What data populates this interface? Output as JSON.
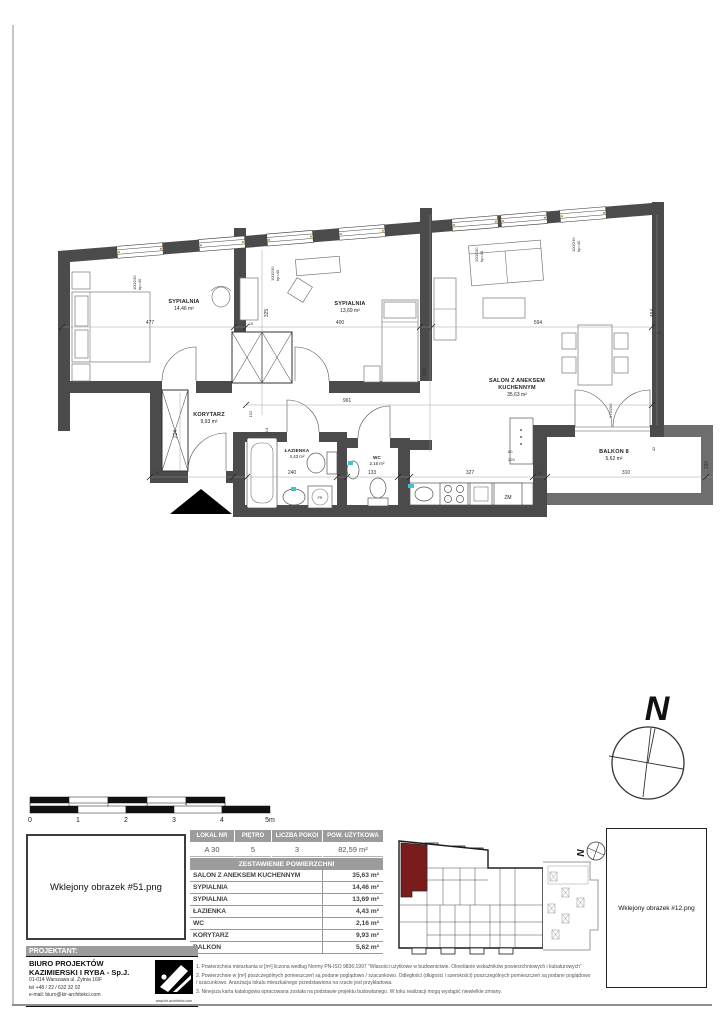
{
  "page": {
    "left_placeholder": "Wklejony obrazek #51.png",
    "right_placeholder": "Wklejony obrazek #12.png"
  },
  "plan": {
    "rooms": {
      "s1": {
        "name": "SYPIALNIA",
        "area": "14,46 m²"
      },
      "s2": {
        "name": "SYPIALNIA",
        "area": "13,69 m²"
      },
      "salon": {
        "l1": "SALON Z ANEKSEM",
        "l2": "KUCHENNYM",
        "area": "35,63 m²"
      },
      "korytarz": {
        "name": "KORYTARZ",
        "area": "9,93 m²"
      },
      "lazienka": {
        "name": "ŁAZIENKA",
        "area": "4,43 m²"
      },
      "wc": {
        "name": "WC",
        "area": "2,16 m²"
      },
      "balkon": {
        "name": "BALKON 8",
        "area": "5,62 m²"
      }
    },
    "fixtures": {
      "zm": "ZM",
      "pr": "PR"
    },
    "window_size": "100/230",
    "window_sill": "hp=40",
    "balcony_door": "175/260",
    "dims": {
      "d477": "477",
      "d10": "10",
      "d325": "325",
      "d400": "400",
      "d594": "594",
      "d494": "494",
      "d42a": "42",
      "d42b": "42",
      "d42c": "42",
      "d680": "680",
      "d961": "961",
      "d152": "152",
      "d14": "14",
      "d224": "224",
      "d25": "25",
      "d240": "240",
      "d133": "133",
      "d327": "327",
      "d310": "310",
      "d180": "180",
      "d60": "60",
      "d220": "220"
    }
  },
  "compass": {
    "north": "N"
  },
  "site_plan": {
    "north": "N"
  },
  "scalebar": {
    "upper": [
      "0",
      "1",
      "2",
      "3",
      "4",
      "5"
    ],
    "lower": [
      "0",
      "1",
      "2",
      "3",
      "4",
      "5m"
    ]
  },
  "unit_table": {
    "headers": [
      "LOKAL NR",
      "PIĘTRO",
      "LICZBA POKOI",
      "POW. UŻYTKOWA"
    ],
    "row": [
      "A 30",
      "5",
      "3",
      "82,59 m²"
    ]
  },
  "area_table": {
    "title": "ZESTAWIENIE POWIERZCHNI",
    "rows": [
      {
        "name": "SALON Z ANEKSEM KUCHENNYM",
        "value": "35,63 m²"
      },
      {
        "name": "SYPIALNIA",
        "value": "14,46 m²"
      },
      {
        "name": "SYPIALNIA",
        "value": "13,69 m²"
      },
      {
        "name": "ŁAZIENKA",
        "value": "4,43 m²"
      },
      {
        "name": "WC",
        "value": "2,16 m²"
      },
      {
        "name": "KORYTARZ",
        "value": "9,93 m²"
      },
      {
        "name": "BALKON",
        "value": "5,62 m²"
      }
    ]
  },
  "designer": {
    "header": "PROJEKTANT:",
    "name1": "BIURO PROJEKTÓW",
    "name2": "KAZIMIERSKI I RYBA - Sp.J.",
    "address": "01-014 Warszawa ul. Żytnia 16/F",
    "phone": "tel +48 / 22 / 632 32 02",
    "email": "e-mail:  biuro@kir-architekci.com",
    "website": "www.kir-architekci.com"
  },
  "notes": [
    "1.  Powierzchnia mieszkania w [m²] liczona według Normy PN-ISO 9836:1997 \"Własości użytkowe w budownictwie. Określanie wskaźników powierzchniowych i kubaturowych\"",
    "2.  Powierzchnie w [m²] poszczególnych pomieszczeń są podane poglądowo / szacunkowo. Odległości (długości i szerokości) poszczególnych pomieszczeń są podane poglądowo / szacunkowo. Aranżacja lokalu mieszkalnego przedstawiona na rzucie jest przykładowa.",
    "3.  Ninejsza karta katalogowa opracowana została na podstawie projektu budowlanego. W toku realizacji mogą wystąpić niewielkie zmiany."
  ],
  "colors": {
    "unit_highlight": "#7b1c1c",
    "wall": "#4b4b4b",
    "table_header": "#9c9c9c"
  }
}
